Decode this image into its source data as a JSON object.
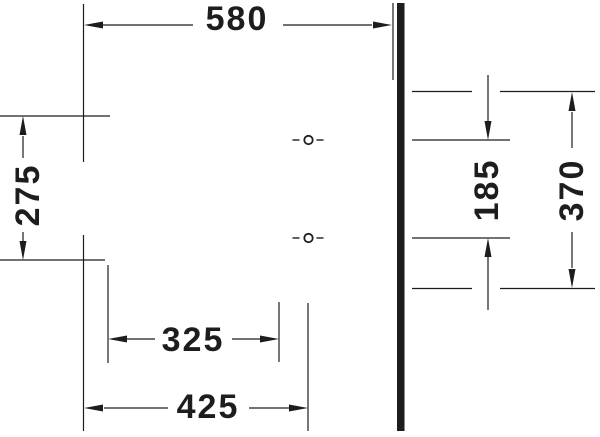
{
  "diagram": {
    "type": "technical-dimension-drawing",
    "colors": {
      "ink": "#1d1d1b",
      "background": "#ffffff"
    },
    "labels": {
      "top_width": "580",
      "left_height": "275",
      "bottom_inner_width": "325",
      "bottom_outer_width": "425",
      "hole_spacing": "185",
      "right_overall_height": "370"
    }
  }
}
